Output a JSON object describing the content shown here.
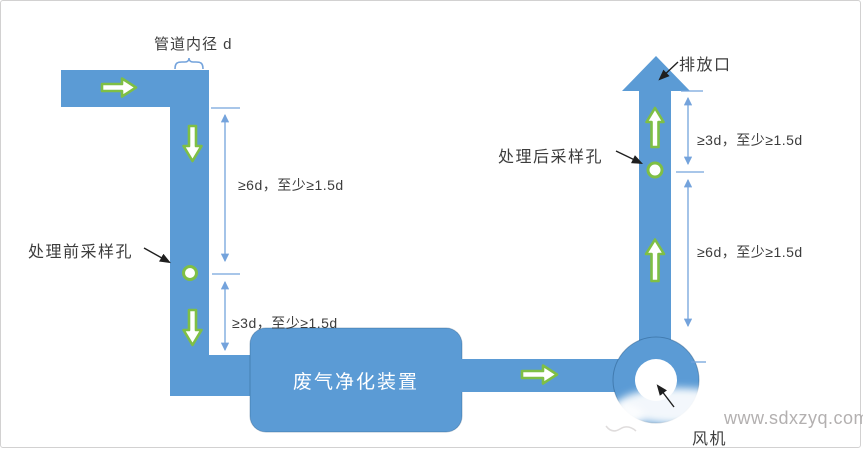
{
  "colors": {
    "pipe": "#5b9bd5",
    "green": "#7fbf45",
    "dim": "#74a3dc",
    "ink": "#3d3d3d",
    "pointer": "#1f1f1f",
    "box_text": "#ffffff",
    "watermark": "#b3b0b0"
  },
  "labels": {
    "pipe_diameter": "管道内径 d",
    "pre_sampling_port": "处理前采样孔",
    "post_sampling_port": "处理后采样孔",
    "outlet": "排放口",
    "purifier_unit": "废气净化装置",
    "fan": "风机"
  },
  "dimension_notes": {
    "left_upper": "≥6d，至少≥1.5d",
    "left_lower": "≥3d，至少≥1.5d",
    "right_upper": "≥3d，至少≥1.5d",
    "right_lower": "≥6d，至少≥1.5d"
  },
  "watermark": "www.sdxzyq.com"
}
